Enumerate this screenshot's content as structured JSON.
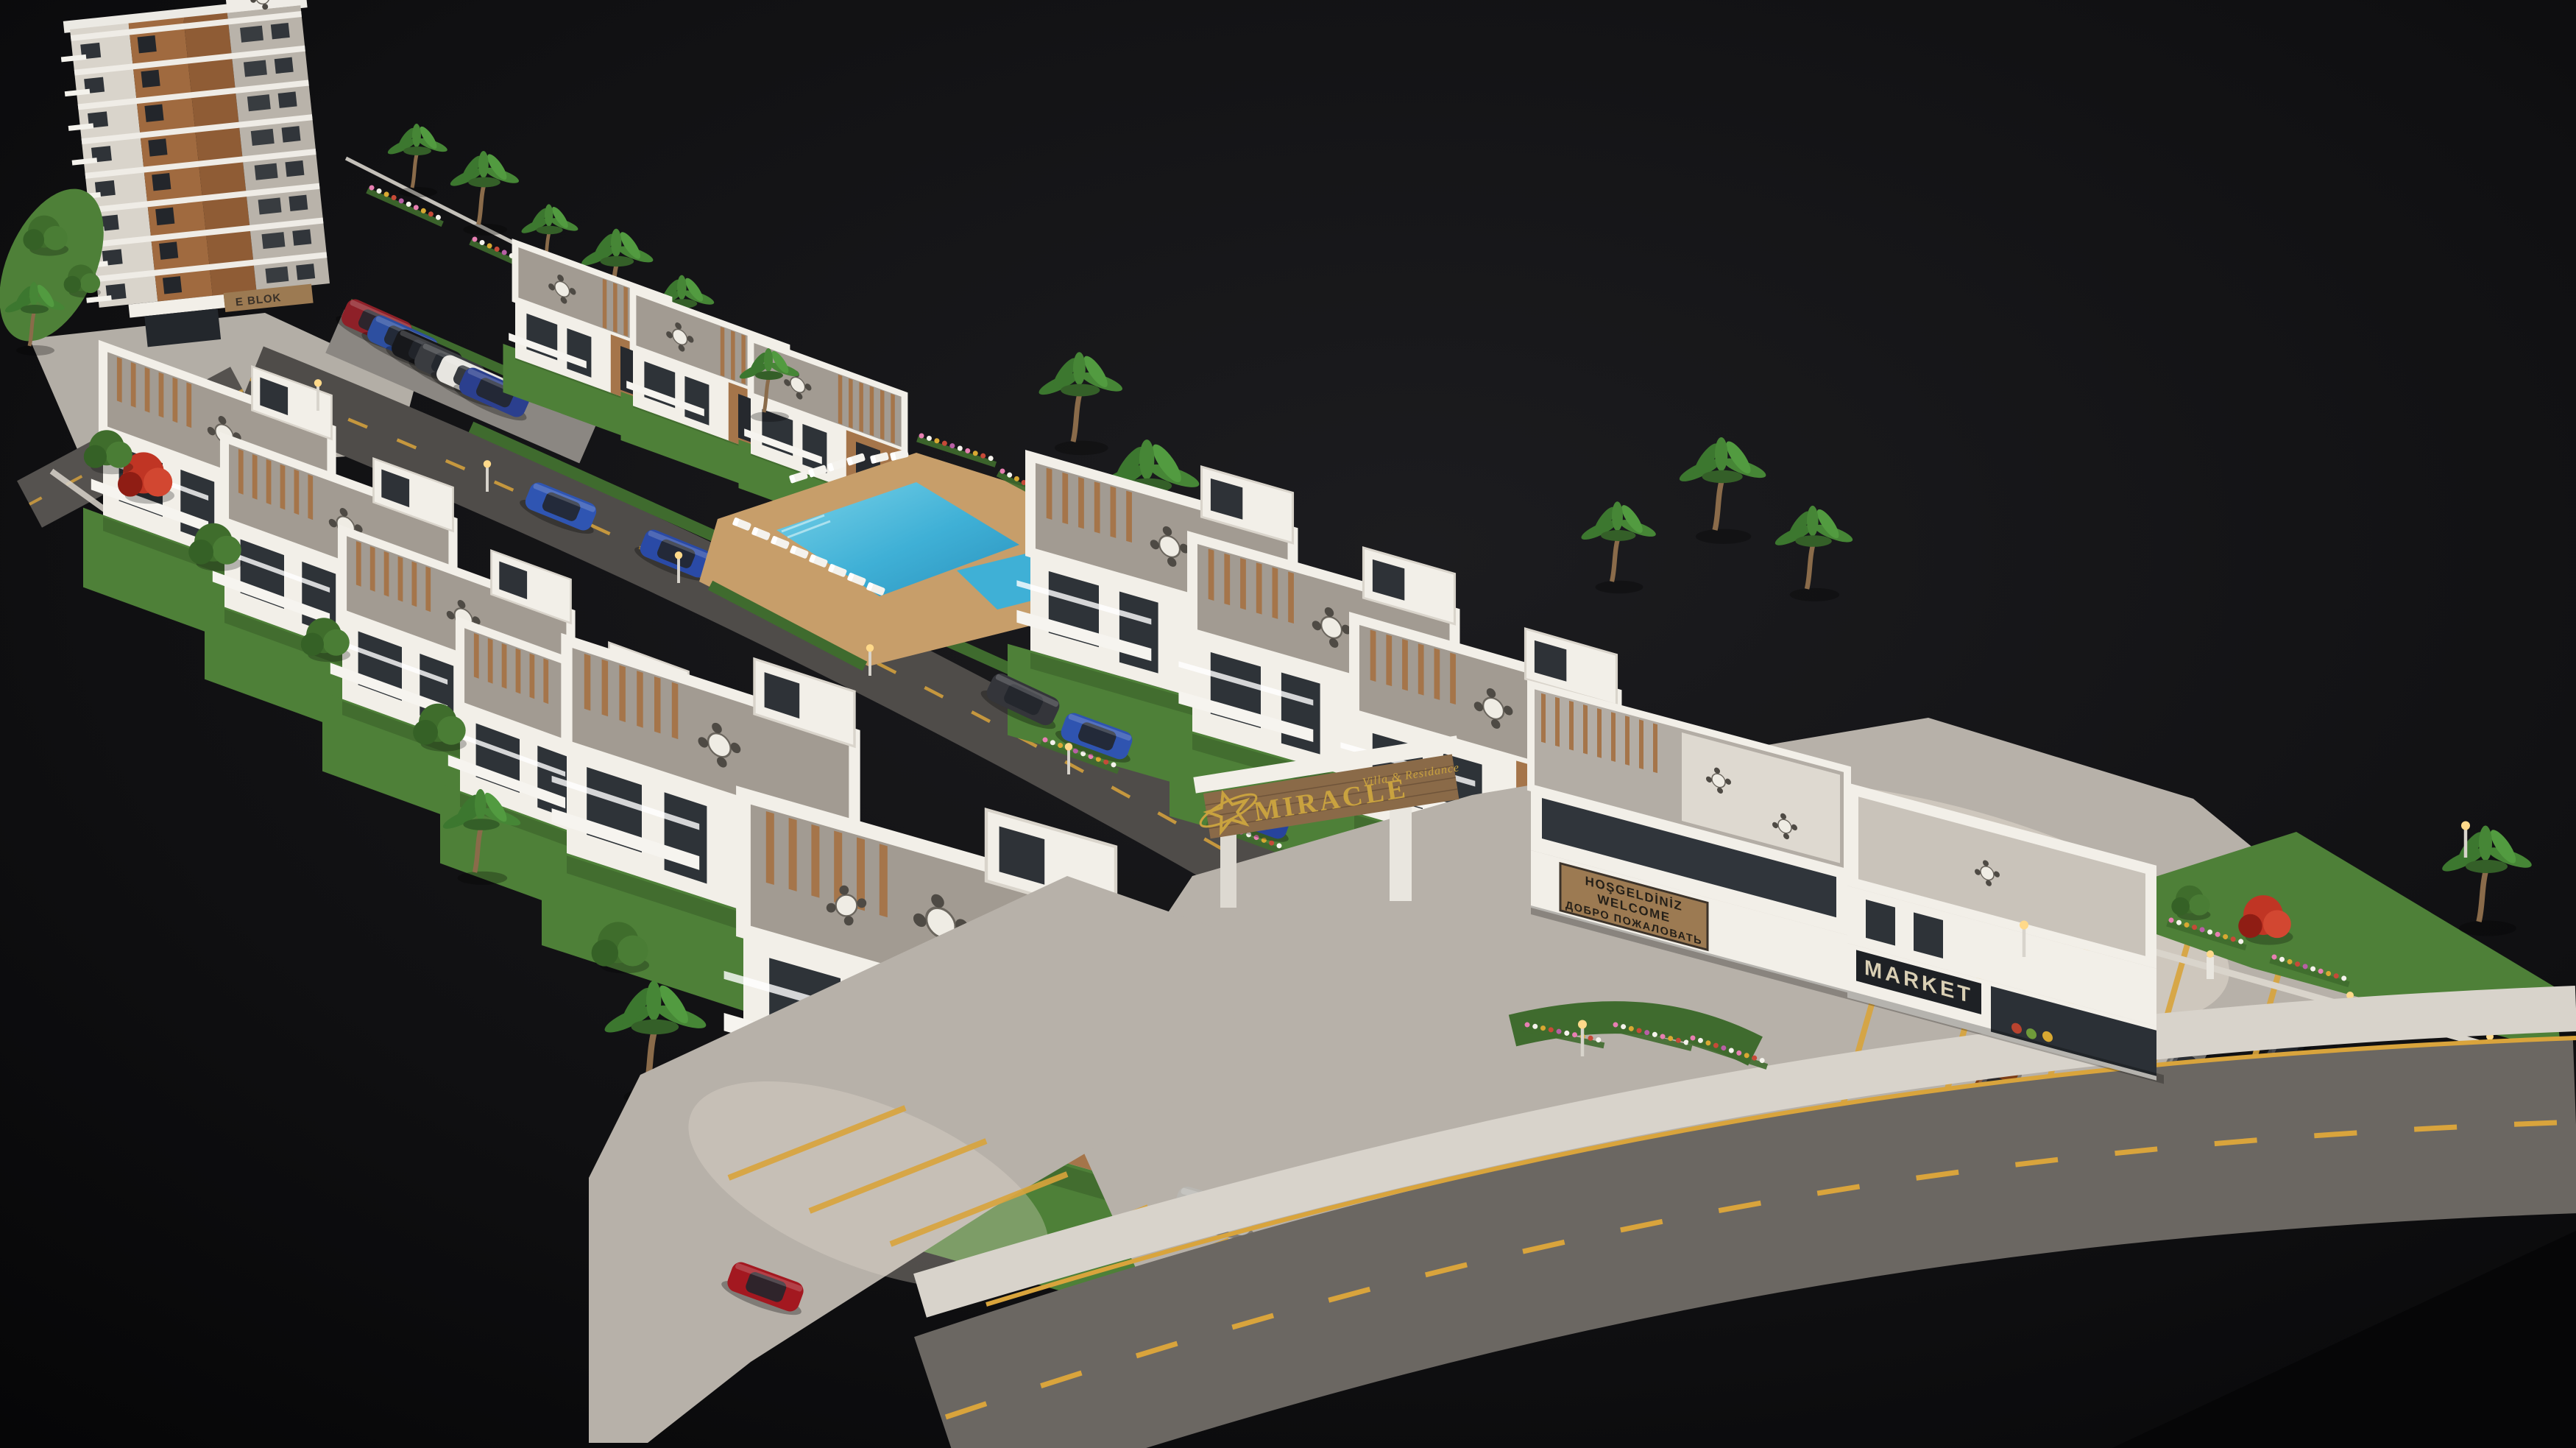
{
  "meta": {
    "title": "Miracle Villa & Residance — aerial 3D architectural rendering",
    "media_type": "3D architectural visualization render",
    "description": "Bird's-eye render of a gated seaside residential development on a black backdrop: an 8-storey apartment block, rows of white villas with wood accents and roof terraces, communal pool with sun loungers, branded entrance gate, market building with roof pergola, internal street and main road with yellow markings, landscaped gardens, palms and parked cars."
  },
  "signs": {
    "entrance_gate": {
      "logo": "star-icon",
      "brand": "MIRACLE",
      "tagline": "Villa & Residance"
    },
    "welcome_board": {
      "lines": [
        "HOŞGELDİNİZ",
        "WELCOME",
        "ДОБРО ПОЖАЛОВАТЬ"
      ]
    },
    "market": {
      "label": "MARKET"
    },
    "apartment_block": {
      "label": "E BLOK"
    }
  },
  "scene": {
    "palette": {
      "background": "#0a0a0c",
      "asphalt_internal": "#4f4c49",
      "asphalt_main": "#6b6762",
      "lane_marking_yellow": "#d9a43c",
      "sidewalk": "#d8d3cb",
      "parking_concrete": "#b7b1a9",
      "sun_patch": "#eae2d4",
      "building_white": "#f2efe8",
      "building_gray": "#a29b92",
      "wood_accent": "#a5754a",
      "glass_dark": "#2e3338",
      "pool_water": "#3fb0d6",
      "pool_deck": "#c79e6a",
      "grass": "#4e8038",
      "hedge": "#3f6b2e",
      "bougainvillea_purple": "#a8408f",
      "flame_tree_red": "#c03524",
      "sign_gold": "#c9a23f",
      "welcome_board_wood": "#9c7a52",
      "sign_text_dark": "#241f18",
      "market_band": "#1e2125",
      "market_text": "#d9cfb4"
    },
    "areas": {
      "apartment_tower": "8-storey apartment block with balconies, top left",
      "villa_rows": "rows of white 2-3 storey villas with wood accents and roof terraces",
      "pool": "communal swimming pool with kids pool, timber deck and sun loungers",
      "entrance_gate": "gated entrance portal with brand sign over the access road",
      "market_building": "two-storey commercial building with market and roof pergola terrace",
      "cafe_terrace": "ground-floor terrace with bougainvillea-covered pergolas and tables",
      "main_road": "asphalt road with dashed yellow centreline, bottom right",
      "parking": "open-air parking bays with yellow markings"
    },
    "cars": [
      {
        "name": "parked-car-red",
        "color": "#8e2028"
      },
      {
        "name": "parked-car-blue",
        "color": "#2d4fa0"
      },
      {
        "name": "parked-car-black",
        "color": "#17181b"
      },
      {
        "name": "parked-car-graphite",
        "color": "#3a3c40"
      },
      {
        "name": "parked-car-white",
        "color": "#e7e5e0"
      },
      {
        "name": "parked-car-navy",
        "color": "#2b3f8e"
      },
      {
        "name": "driveway-car-blue-1",
        "color": "#2f55b2"
      },
      {
        "name": "driveway-car-blue-2",
        "color": "#2a4aa6"
      },
      {
        "name": "road-car-dark",
        "color": "#34353a"
      },
      {
        "name": "driveway-car-blue-3",
        "color": "#2f54b0"
      },
      {
        "name": "driveway-car-blue-4",
        "color": "#27449c"
      },
      {
        "name": "lot-car-red",
        "color": "#a31820"
      },
      {
        "name": "lot-car-silver",
        "color": "#b9b7b2"
      },
      {
        "name": "lot-car-orange-suv",
        "color": "#7c3d18"
      },
      {
        "name": "lot-car-gray",
        "color": "#6e6d6b"
      },
      {
        "name": "lot-car-black",
        "color": "#141518"
      }
    ]
  }
}
